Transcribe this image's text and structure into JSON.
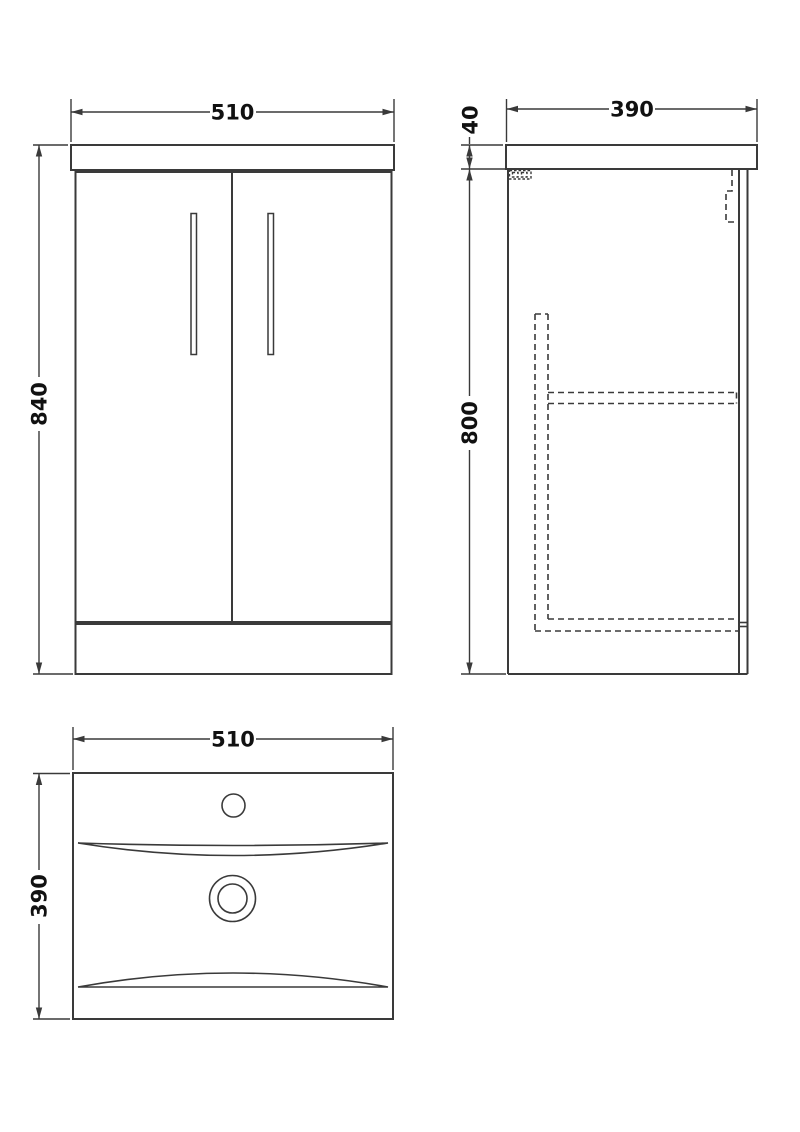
{
  "drawing": {
    "kind": "technical dimension drawing",
    "subject": "vanity unit with basin",
    "line_color": "#3a3a3a",
    "background": "#ffffff",
    "views": {
      "front": {
        "name": "front elevation",
        "dim_width": "510",
        "dim_height": "840"
      },
      "side": {
        "name": "side elevation",
        "dim_depth": "390",
        "dim_worktop_thickness": "40",
        "dim_cabinet_height": "800"
      },
      "plan": {
        "name": "basin plan view",
        "dim_width": "510",
        "dim_depth": "390"
      }
    }
  }
}
